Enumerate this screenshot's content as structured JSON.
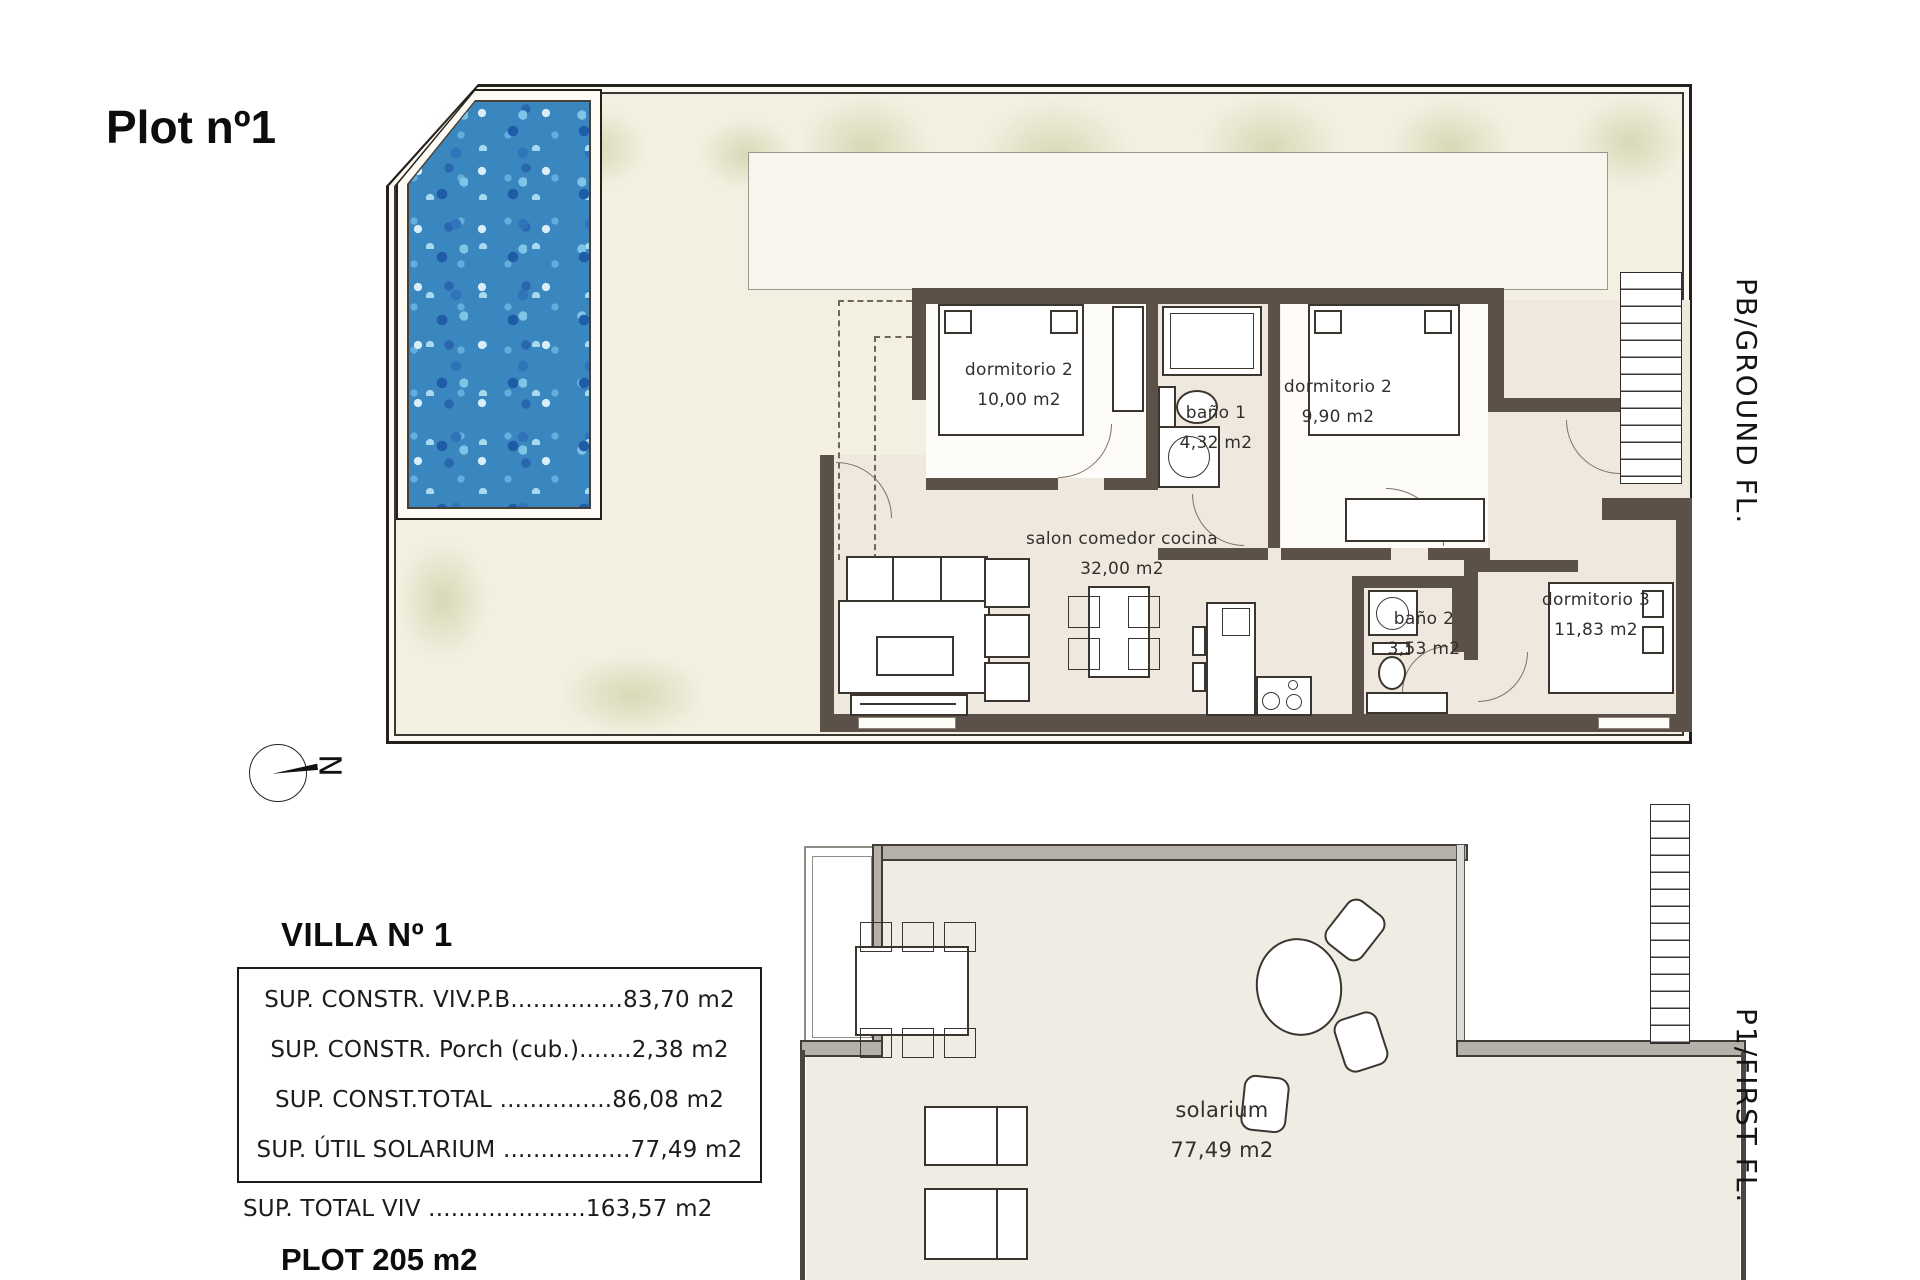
{
  "title": "Plot nº1",
  "compass": {
    "letter": "N"
  },
  "side_labels": {
    "ground": "PB/GROUND FL.",
    "first": "P1/FIRST FL."
  },
  "ground_floor": {
    "rooms": {
      "dormitorio2_left": {
        "name": "dormitorio 2",
        "area": "10,00 m2"
      },
      "bano1": {
        "name": "baño 1",
        "area": "4,32 m2"
      },
      "dormitorio2_right": {
        "name": "dormitorio 2",
        "area": "9,90 m2"
      },
      "salon": {
        "name": "salon comedor cocina",
        "area": "32,00 m2"
      },
      "bano2": {
        "name": "baño 2",
        "area": "3,53 m2"
      },
      "dormitorio3": {
        "name": "dormitorio 3",
        "area": "11,83 m2"
      }
    }
  },
  "first_floor": {
    "rooms": {
      "solarium": {
        "name": "solarium",
        "area": "77,49 m2"
      }
    }
  },
  "summary": {
    "title": "VILLA Nº 1",
    "rows": [
      "SUP. CONSTR. VIV.P.B...............83,70 m2",
      "SUP. CONSTR. Porch (cub.).......2,38 m2",
      "SUP. CONST.TOTAL ...............86,08 m2",
      "SUP. ÚTIL SOLARIUM .................77,49 m2"
    ],
    "total_row": "SUP. TOTAL VIV .....................163,57 m2",
    "plot_row": "PLOT 205 m2"
  },
  "colors": {
    "wall": "#5b5149",
    "pool_water": "#3a87c0",
    "plot_fill": "#f3f0e1",
    "interior_fill": "#efe8de",
    "band_gray": "#b5b1aa"
  }
}
